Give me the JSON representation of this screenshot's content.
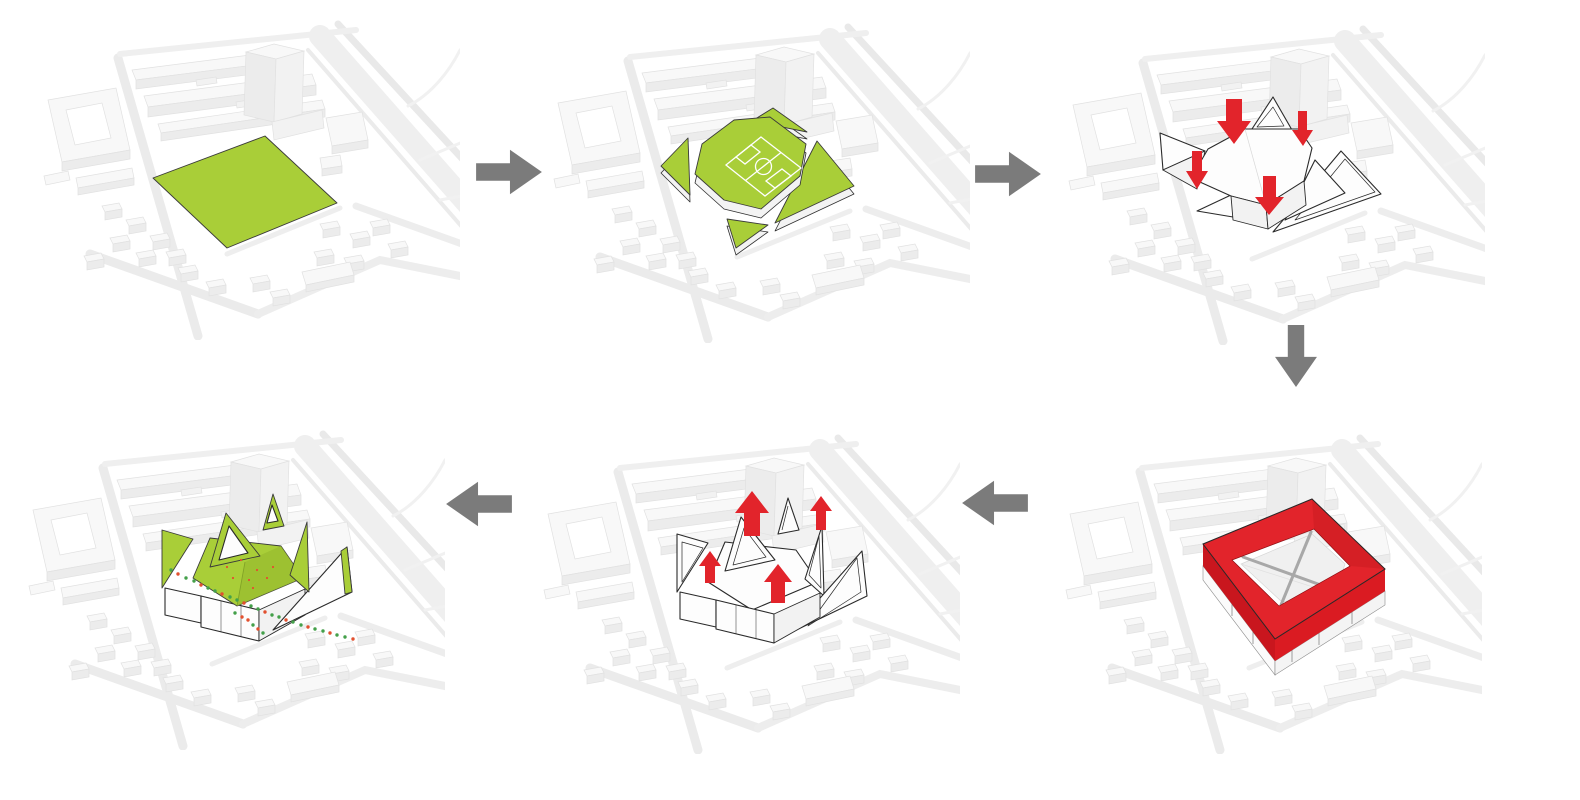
{
  "canvas": {
    "width": 1580,
    "height": 800,
    "background": "#ffffff"
  },
  "colors": {
    "site_green": "#a9ce38",
    "green_shade": "#96ba2e",
    "accent_red": "#e2242b",
    "red_front_left": "#c9161e",
    "red_front_right": "#da1b22",
    "red_inner_wall": "#b31219",
    "flow_arrow_gray": "#7b7b7b",
    "model_top": "#f8f8f8",
    "model_front": "#ececec",
    "model_side": "#f2f2f2",
    "model_edge": "#e1e1e1",
    "road": "#ebebeb",
    "field_line": "#ffffff",
    "dot_green": "#44a04a",
    "dot_red": "#e2502f",
    "outline_ink": "#2a2a2a"
  },
  "panels": [
    {
      "name": "step-1-green-site-area"
    },
    {
      "name": "step-2-site-cut-into-green-plates-with-football-field"
    },
    {
      "name": "step-3-white-folded-plates-pressed-down"
    },
    {
      "name": "step-4-red-frame-volume"
    },
    {
      "name": "step-5-roof-plates-lifted-up"
    },
    {
      "name": "step-6-green-folded-roofscape-with-landscape-dots"
    }
  ],
  "flow_arrows": [
    {
      "name": "arrow-step1-to-step2",
      "direction": "right"
    },
    {
      "name": "arrow-step2-to-step3",
      "direction": "right"
    },
    {
      "name": "arrow-step3-to-step4",
      "direction": "down"
    },
    {
      "name": "arrow-step4-to-step5",
      "direction": "left"
    },
    {
      "name": "arrow-step5-to-step6",
      "direction": "left"
    }
  ]
}
